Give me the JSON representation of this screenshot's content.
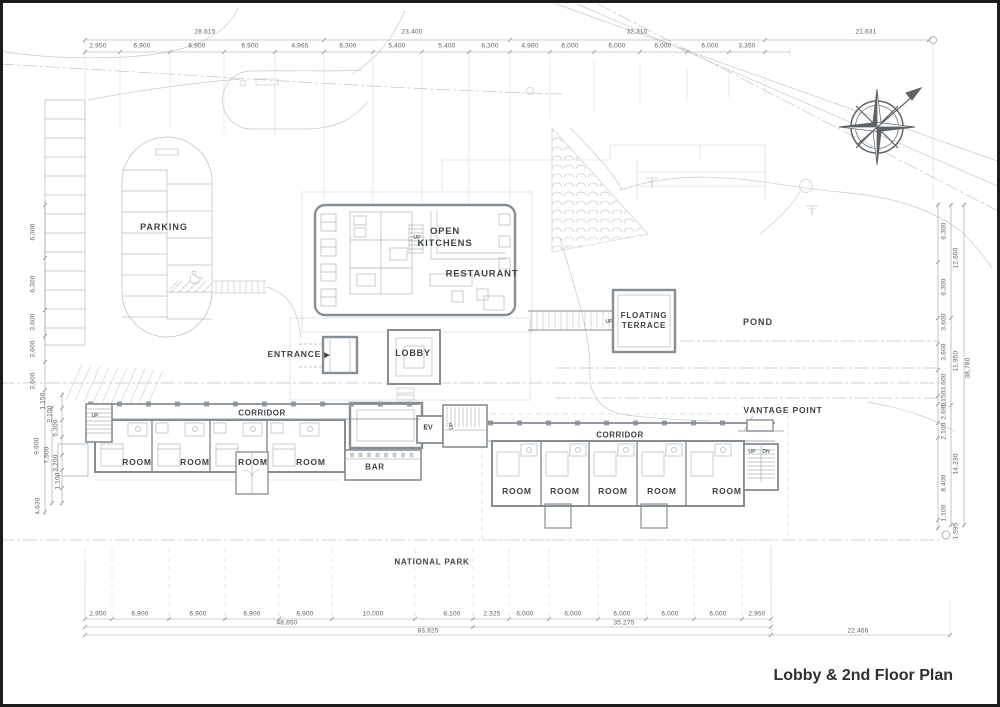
{
  "title": {
    "text": "Lobby & 2nd Floor Plan"
  },
  "labels": {
    "parking": "PARKING",
    "open_kitchens_1": "OPEN",
    "open_kitchens_2": "KITCHENS",
    "restaurant": "RESTAURANT",
    "entrance": "ENTRANCE",
    "entrance_arrow": "▶",
    "lobby": "LOBBY",
    "floating_terrace_1": "FLOATING",
    "floating_terrace_2": "TERRACE",
    "pond": "POND",
    "vantage_point": "VANTAGE POINT",
    "corridor": "CORRIDOR",
    "bar": "BAR",
    "ev": "EV",
    "room": "ROOM",
    "national_park": "NATIONAL PARK",
    "up": "UP",
    "dn": "DN"
  },
  "dimensions": {
    "top_overall": [
      "28,615",
      "23,400",
      "32,310",
      "21,631"
    ],
    "top_segments": [
      "2,950",
      "6,900",
      "6,900",
      "6,900",
      "4,965",
      "6,300",
      "5,400",
      "5,400",
      "6,300",
      "4,960",
      "6,000",
      "6,000",
      "6,000",
      "6,000",
      "3,350"
    ],
    "left_column": [
      "6,300",
      "6,300",
      "3,600",
      "3,600",
      "3,600",
      "1,150",
      "2,100",
      "5,300",
      "9,600",
      "7,500",
      "3,200",
      "1,100",
      "4,630"
    ],
    "right_column": [
      "6,300",
      "12,600",
      "6,300",
      "3,600",
      "3,600",
      "11,950",
      "38,780",
      "3,600",
      "1,150",
      "2,690",
      "2,100",
      "14,230",
      "8,400",
      "1,100",
      "1,595"
    ],
    "bottom_segments": [
      "2,950",
      "6,900",
      "6,900",
      "6,900",
      "6,900",
      "10,000",
      "8,100",
      "2,325",
      "6,000",
      "6,000",
      "6,000",
      "6,000",
      "6,000",
      "2,950"
    ],
    "bottom_spans": [
      "48,650",
      "35,275"
    ],
    "bottom_totals": [
      "83,925",
      "22,466"
    ]
  },
  "colors": {
    "paper": "#ffffff",
    "site_linework": "#c6cbce",
    "building_walls": "#868d93",
    "label_text": "#3e4347",
    "frame": "#1c1c1c"
  }
}
